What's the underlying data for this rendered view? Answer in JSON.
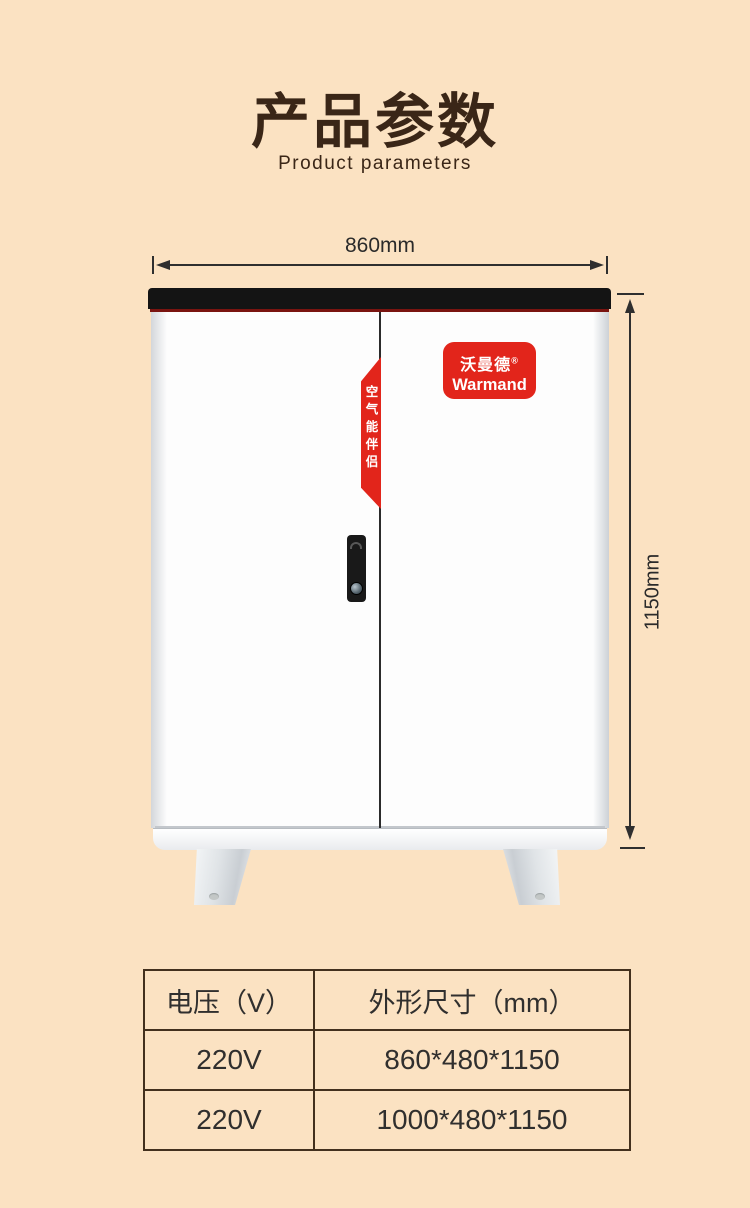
{
  "header": {
    "title": "产品参数",
    "subtitle": "Product parameters"
  },
  "diagram": {
    "width_label": "860mm",
    "height_label": "1150mm",
    "ribbon_text": "空气能伴侣",
    "badge": {
      "brand_cn": "沃曼德",
      "brand_reg": "®",
      "brand_en": "Warmand"
    }
  },
  "table": {
    "headers": [
      "电压（V）",
      "外形尺寸（mm）"
    ],
    "rows": [
      [
        "220V",
        "860*480*1150"
      ],
      [
        "220V",
        "1000*480*1150"
      ]
    ]
  },
  "colors": {
    "background": "#fbe2c2",
    "title_brown": "#3a2617",
    "brand_red": "#e2251b",
    "trim_dark_red": "#7a1410",
    "panel_black": "#141414",
    "dimension_ink": "#2f2f2f",
    "table_border": "#43301d"
  }
}
